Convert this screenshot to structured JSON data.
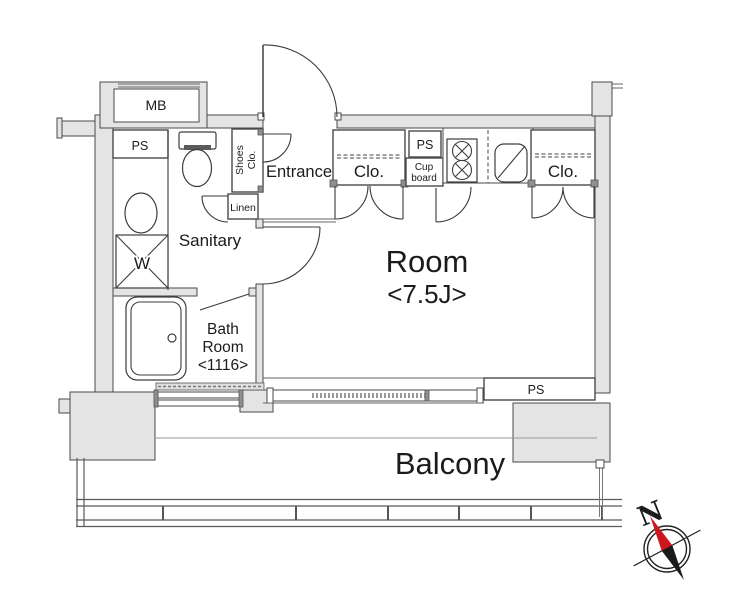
{
  "plan": {
    "labels": {
      "mb": "MB",
      "ps_top": "PS",
      "shoes_line1": "Shoes",
      "shoes_line2": "Clo.",
      "entrance": "Entrance",
      "linen": "Linen",
      "sanitary": "Sanitary",
      "washer": "W",
      "bath_line1": "Bath",
      "bath_line2": "Room",
      "bath_size": "<1116>",
      "closet_left": "Clo.",
      "ps_kitchen": "PS",
      "cupboard_line1": "Cup",
      "cupboard_line2": "board",
      "closet_right": "Clo.",
      "room": "Room",
      "room_size": "<7.5J>",
      "ps_bottom": "PS",
      "balcony": "Balcony",
      "compass_north": "N"
    },
    "colors": {
      "wall_fill": "#e4e4e4",
      "wall_stroke": "#4a4a4a",
      "line": "#3a3a3a",
      "text": "#1b1b1b",
      "compass_red": "#cc1620",
      "compass_black": "#1a1a1a"
    }
  }
}
